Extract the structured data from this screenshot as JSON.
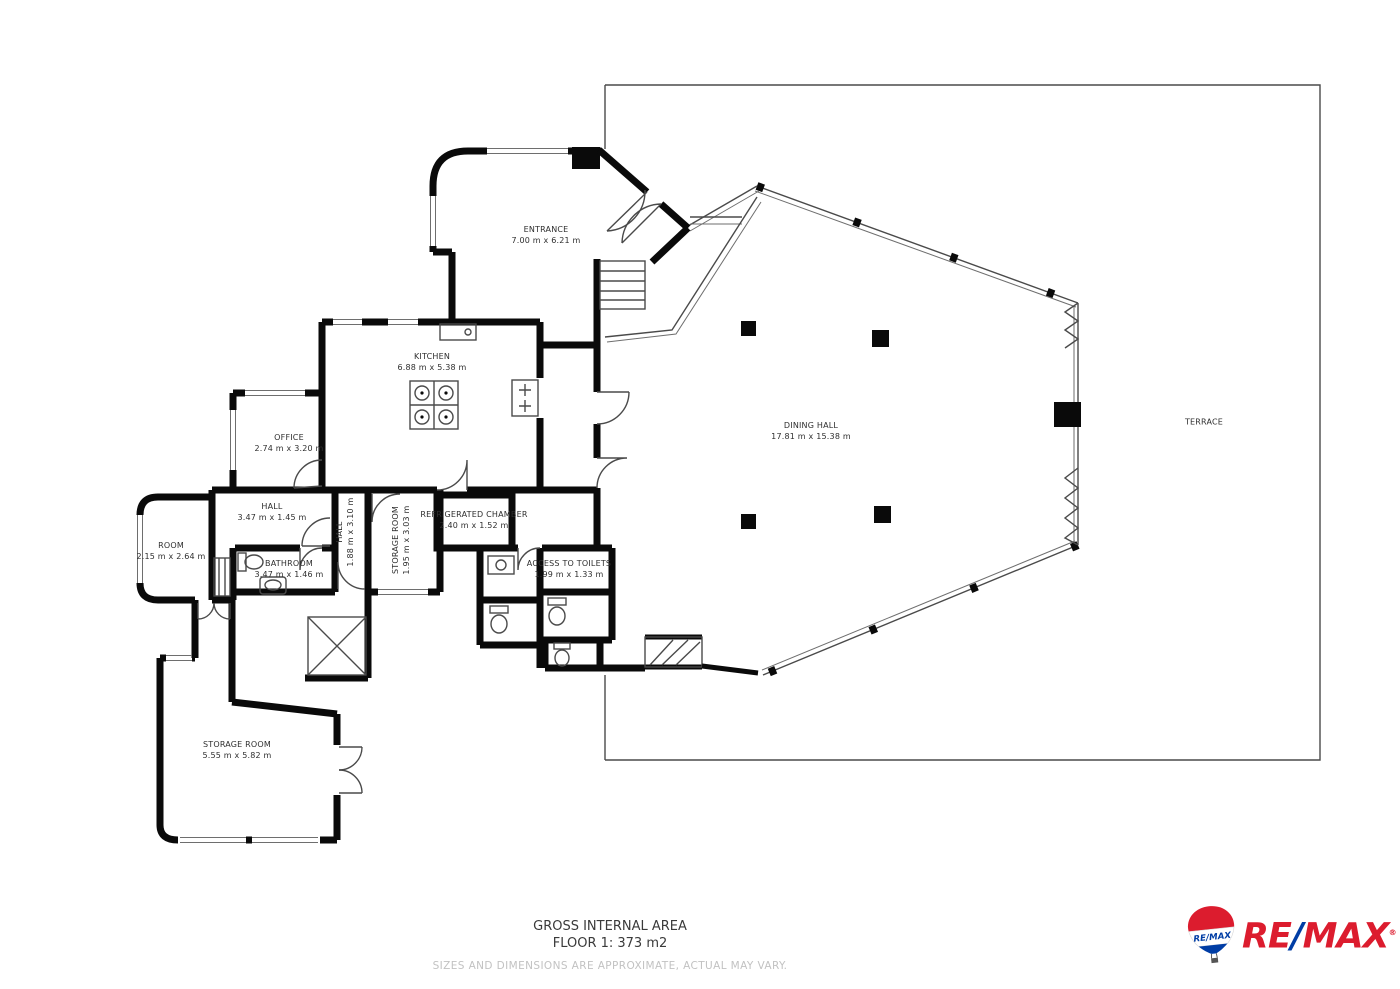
{
  "rooms": {
    "entrance": {
      "name": "ENTRANCE",
      "dims": "7.00 m x 6.21 m"
    },
    "kitchen": {
      "name": "KITCHEN",
      "dims": "6.88 m x 5.38 m"
    },
    "office": {
      "name": "OFFICE",
      "dims": "2.74 m x 3.20 m"
    },
    "hall": {
      "name": "HALL",
      "dims": "3.47 m x 1.45 m"
    },
    "room": {
      "name": "ROOM",
      "dims": "2.15 m x 2.64 m"
    },
    "bathroom": {
      "name": "BATHROOM",
      "dims": "3.47 m x 1.46 m"
    },
    "hall_vertical": {
      "name": "HALL",
      "dims": "1.88 m x 3.10 m"
    },
    "storage_mid": {
      "name": "STORAGE ROOM",
      "dims": "1.95 m x 3.03 m"
    },
    "refrigerated": {
      "name": "REFRIGERATED CHAMBER",
      "dims": "2.40 m x 1.52 m"
    },
    "access_toilets": {
      "name": "ACCESS TO TOILETS",
      "dims": "1.99 m x 1.33 m"
    },
    "dining": {
      "name": "DINING HALL",
      "dims": "17.81 m x 15.38 m"
    },
    "terrace": {
      "name": "TERRACE",
      "dims": ""
    },
    "storage_bottom": {
      "name": "STORAGE ROOM",
      "dims": "5.55 m x 5.82 m"
    }
  },
  "footer": {
    "area_title": "GROSS INTERNAL AREA",
    "area_value": "FLOOR 1: 373 m2",
    "disclaimer": "SIZES AND DIMENSIONS ARE APPROXIMATE, ACTUAL MAY VARY."
  },
  "branding": {
    "wordmark_re": "RE",
    "wordmark_slash": "/",
    "wordmark_max": "MAX",
    "reg_mark": "®",
    "balloon_text": "RE/MAX",
    "red": "#DC1C2E",
    "blue": "#003DA5"
  }
}
